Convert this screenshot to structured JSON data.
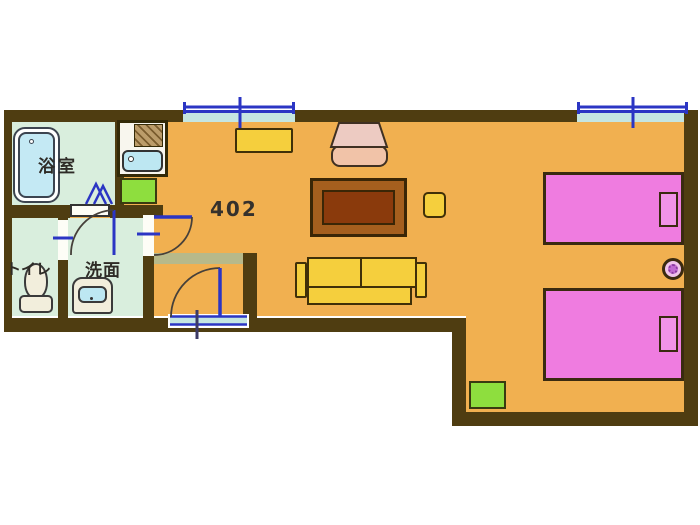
{
  "plan": {
    "unit_number": "402",
    "labels": {
      "bathroom": "浴室",
      "toilet": "トイレ",
      "washbasin": "洗面"
    },
    "colors": {
      "floor_main": "#f1b050",
      "floor_wet": "#d9eedd",
      "wall": "#4f3d11",
      "window_blue": "#2b35c4",
      "window_sill": "#c5e6e2",
      "bed_pink": "#ef7ce0",
      "furniture_yellow": "#f5cf3d",
      "table_frame": "#a55f1e",
      "table_top": "#8a3a0c",
      "mat_green": "#8ede3e",
      "fixture_blue": "#bde7f2",
      "chair_salmon": "#f1c3a8",
      "genkan_step": "#b7b98a"
    },
    "fixtures": [
      "bathtub",
      "kitchen-stove",
      "kitchen-sink",
      "toilet",
      "washbasin"
    ],
    "furniture": [
      "cabinet",
      "armchair",
      "low-table",
      "side-table",
      "sofa",
      "bed-1",
      "bed-2",
      "stool",
      "floor-cushion",
      "kitchen-mat"
    ],
    "openings": {
      "windows": 2,
      "doors": [
        "entrance-door",
        "main-room-door",
        "bathroom-folding-door",
        "washroom-door",
        "toilet-door"
      ]
    }
  }
}
